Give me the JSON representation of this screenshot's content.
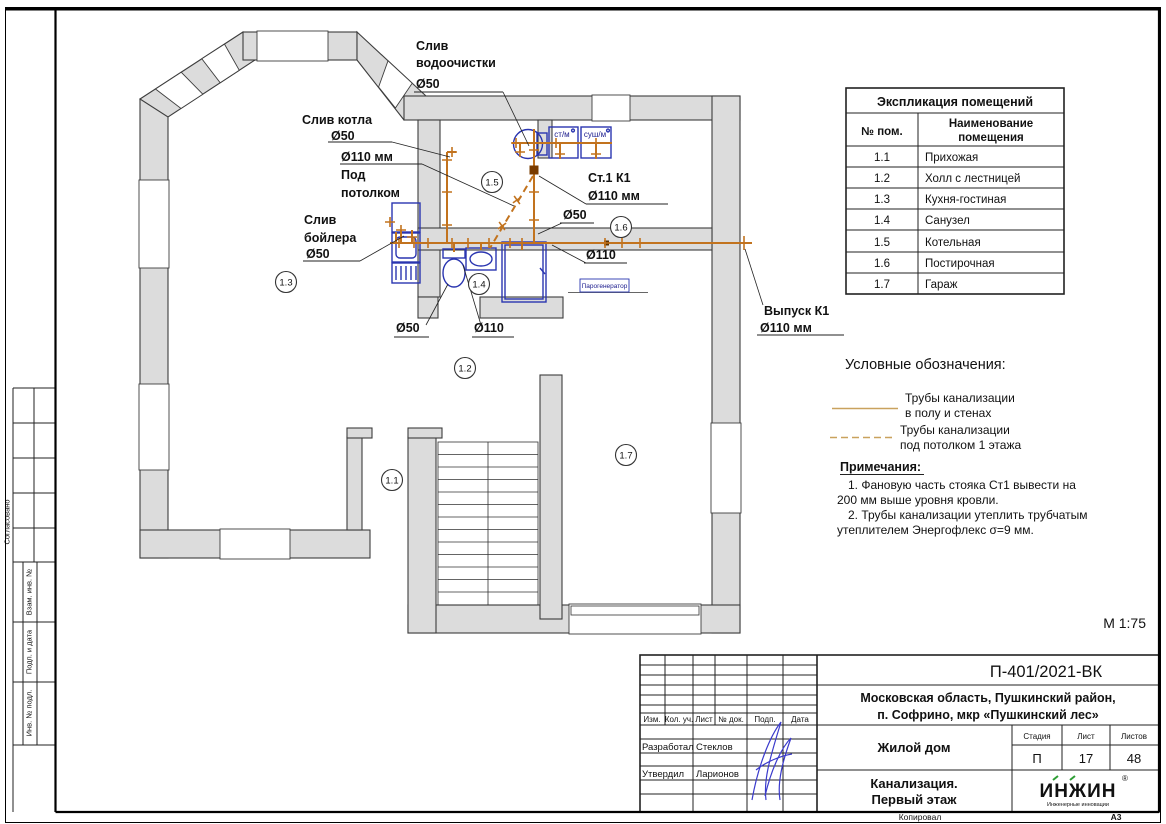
{
  "page": {
    "scale": "М 1:75",
    "copied": "Копировал",
    "format": "А3"
  },
  "side_column": {
    "agreed": "Согласовано",
    "vzam": "Взам. инв. №",
    "podp": "Подп. и дата",
    "inv": "Инв. № подл."
  },
  "plan": {
    "rooms": {
      "r11": "1.1",
      "r12": "1.2",
      "r13": "1.3",
      "r14": "1.4",
      "r15": "1.5",
      "r16": "1.6",
      "r17": "1.7"
    },
    "labels": {
      "water_drain_1": "Слив",
      "water_drain_2": "водоочистки",
      "water_drain_3": "Ø50",
      "boiler_unit_drain_1": "Слив котла",
      "boiler_unit_drain_2": "Ø50",
      "ceiling_pipe_1": "Ø110 мм",
      "ceiling_pipe_2": "Под",
      "ceiling_pipe_3": "потолком",
      "tank_drain_1": "Слив",
      "tank_drain_2": "бойлера",
      "tank_drain_3": "Ø50",
      "stack_1": "Ст.1  К1",
      "stack_2": "Ø110 мм",
      "d50_stack": "Ø50",
      "d110_laundry": "Ø110",
      "d50_bath": "Ø50",
      "d110_bath": "Ø110",
      "outlet_1": "Выпуск К1",
      "outlet_2": "Ø110 мм",
      "washer": "ст/м",
      "dryer": "суш/м",
      "steam_generator": "Парогенератор"
    }
  },
  "explication": {
    "title": "Экспликация помещений",
    "col_num": "№ пом.",
    "col_name_1": "Наименование",
    "col_name_2": "помещения",
    "rows": [
      {
        "num": "1.1",
        "name": "Прихожая"
      },
      {
        "num": "1.2",
        "name": "Холл с лестницей"
      },
      {
        "num": "1.3",
        "name": "Кухня-гостиная"
      },
      {
        "num": "1.4",
        "name": "Санузел"
      },
      {
        "num": "1.5",
        "name": "Котельная"
      },
      {
        "num": "1.6",
        "name": "Постирочная"
      },
      {
        "num": "1.7",
        "name": "Гараж"
      }
    ]
  },
  "legend": {
    "title": "Условные обозначения:",
    "item1_line1": "Трубы канализации",
    "item1_line2": "в полу и стенах",
    "item2_line1": "Трубы канализации",
    "item2_line2": "под потолком 1 этажа"
  },
  "notes": {
    "title": "Примечания:",
    "line1a": "1.    Фановую часть стояка Ст1   вывести на",
    "line1b": "200 мм выше уровня кровли.",
    "line2a": "2.    Трубы канализации утеплить трубчатым",
    "line2b": "утеплителем Энергофлекс σ=9 мм."
  },
  "stamp": {
    "doc_number": "П-401/2021-ВК",
    "address1": "Московская область, Пушкинский район,",
    "address2": "п. Софрино, мкр «Пушкинский лес»",
    "object": "Жилой дом",
    "sheet_name1": "Канализация.",
    "sheet_name2": "Первый этаж",
    "col_izm": "Изм.",
    "col_kol": "Кол. уч.",
    "col_list": "Лист",
    "col_ndok": "№ док.",
    "col_podp": "Подп.",
    "col_data": "Дата",
    "role1": "Разработал",
    "name1": "Стеклов",
    "role2": "Утвердил",
    "name2": "Ларионов",
    "stage_label": "Стадия",
    "list_label": "Лист",
    "listov_label": "Листов",
    "stage": "П",
    "list": "17",
    "listov": "48",
    "logo": "ИНЖИН",
    "logo_r": "®",
    "logo_sub": "Инженерные инновации"
  },
  "colors": {
    "pipe": "#c2731e",
    "legend_line": "#c9a25e",
    "wall_fill": "#dcdcdc",
    "fixture_blue": "#2a35b0",
    "logo_green": "#2e9e35",
    "signature_blue": "#3a3acc"
  }
}
